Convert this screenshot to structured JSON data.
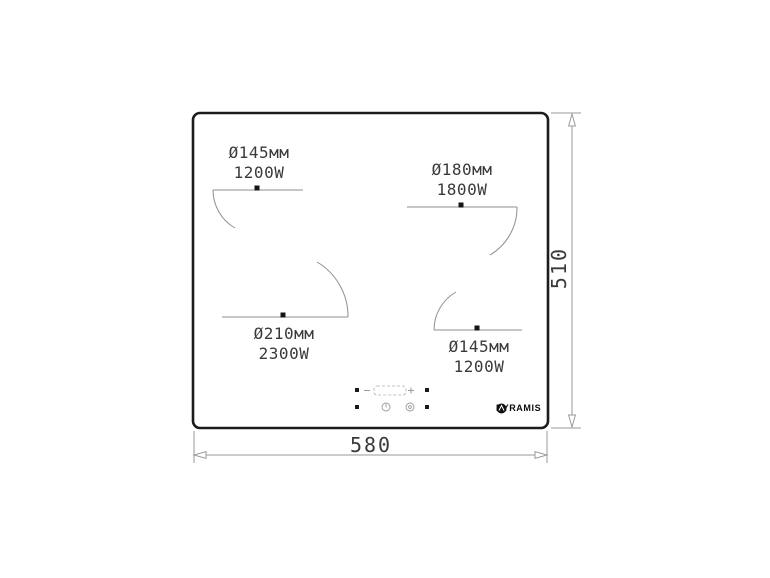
{
  "drawing": {
    "type": "built-in hob technical dimension drawing",
    "brand": "PYRAMIS",
    "dimensions": {
      "width_mm": "580",
      "height_mm": "510"
    },
    "zones": [
      {
        "position": "top-left",
        "diameter": "Ø145мм",
        "power": "1200W"
      },
      {
        "position": "top-right",
        "diameter": "Ø180мм",
        "power": "1800W"
      },
      {
        "position": "bottom-left",
        "diameter": "Ø210мм",
        "power": "2300W"
      },
      {
        "position": "bottom-right",
        "diameter": "Ø145мм",
        "power": "1200W"
      }
    ],
    "colors": {
      "outline": "#1c1c1c",
      "thin_lines": "#8f8f8f",
      "dimension_lines": "#9a9a9a",
      "label_text": "#3a3a3a",
      "brand_color": "#0d0d0d",
      "background": "#ffffff"
    }
  }
}
